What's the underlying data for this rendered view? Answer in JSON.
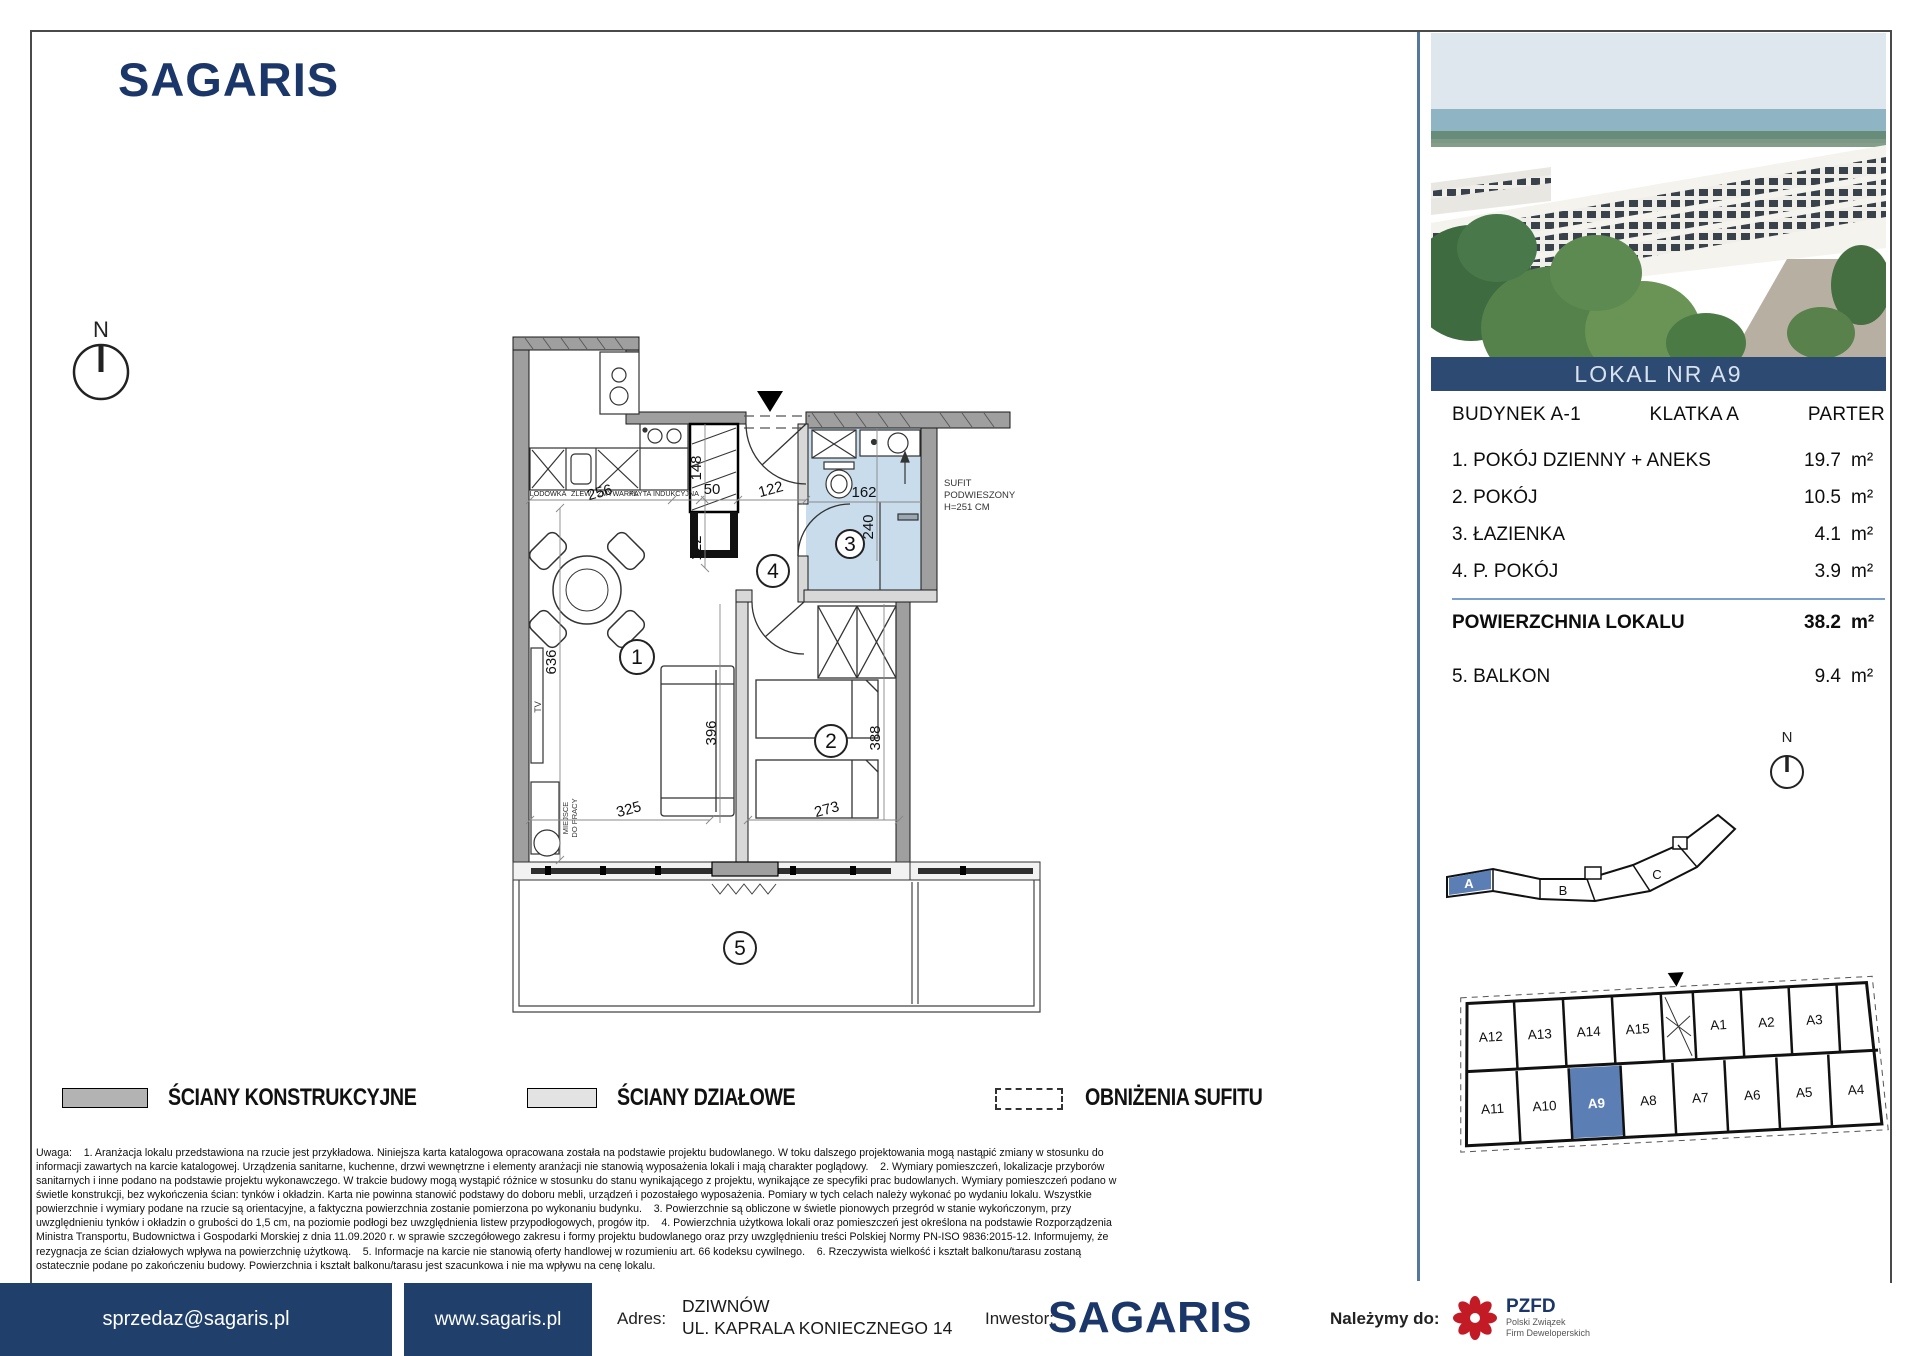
{
  "brand": {
    "logo": "SAGARIS"
  },
  "photo_banner": {
    "label": "LOKAL NR A9"
  },
  "unit_table": {
    "building": "BUDYNEK A-1",
    "staircase": "KLATKA A",
    "floor": "PARTER",
    "rooms": [
      {
        "name": "1. POKÓJ DZIENNY + ANEKS",
        "area": "19.7",
        "unit": "m²"
      },
      {
        "name": "2. POKÓJ",
        "area": "10.5",
        "unit": "m²"
      },
      {
        "name": "3. ŁAZIENKA",
        "area": "4.1",
        "unit": "m²"
      },
      {
        "name": "4. P. POKÓJ",
        "area": "3.9",
        "unit": "m²"
      }
    ],
    "total_label": "POWIERZCHNIA LOKALU",
    "total_area": "38.2",
    "total_unit": "m²",
    "balcony_label": "5. BALKON",
    "balcony_area": "9.4",
    "balcony_unit": "m²"
  },
  "floor_plan": {
    "north": "N",
    "rooms": {
      "r1": "1",
      "r2": "2",
      "r3": "3",
      "r4": "4",
      "r5": "5"
    },
    "dims": {
      "kitchen": "256",
      "shaft_w": "50",
      "hall_w": "122",
      "shaft_h": "148",
      "hall_h": "122",
      "living_h": "636",
      "living_w": "325",
      "sofa_l": "396",
      "bed_w": "273",
      "bed_h": "388",
      "bath_w": "162",
      "bath_h": "240"
    },
    "kitchen_labels": {
      "fridge": "LODÓWKA",
      "sink": "ZLEW",
      "dishwasher": "ZMYWARKA",
      "hob": "PŁYTA INDUKCYJNA"
    },
    "tv_label": "TV",
    "workspace_l1": "MIEJSCE",
    "workspace_l2": "DO PRACY",
    "ceiling_note_l1": "SUFIT",
    "ceiling_note_l2": "PODWIESZONY",
    "ceiling_note_l3": "H=251 CM"
  },
  "legend": {
    "item1": "ŚCIANY KONSTRUKCYJNE",
    "item2": "ŚCIANY DZIAŁOWE",
    "item3": "OBNIŻENIA SUFITU"
  },
  "site_plan": {
    "a": "A",
    "b": "B",
    "c": "C"
  },
  "unit_map": {
    "top_row": [
      "A12",
      "A13",
      "A14",
      "A15",
      "A1",
      "A2",
      "A3"
    ],
    "bottom_row": [
      "A11",
      "A10",
      "A9",
      "A8",
      "A7",
      "A6",
      "A5",
      "A4"
    ],
    "highlighted": "A9"
  },
  "disclaimer": "Uwaga:    1. Aranżacja lokalu przedstawiona na rzucie jest przykładowa. Niniejsza karta katalogowa opracowana została na podstawie projektu budowlanego. W toku dalszego projektowania mogą nastąpić zmiany w stosunku do informacji zawartych na karcie katalogowej. Urządzenia sanitarne, kuchenne, drzwi wewnętrzne i elementy aranżacji nie stanowią wyposażenia lokali i mają charakter poglądowy.    2. Wymiary pomieszczeń, lokalizacje przyborów sanitarnych i inne podano na podstawie projektu wykonawczego. W trakcie budowy mogą wystąpić różnice w stosunku do stanu wynikającego z projektu, wynikające ze specyfiki prac budowlanych. Wymiary pomieszczeń podano w świetle konstrukcji, bez wykończenia ścian: tynków i okładzin. Karta nie powinna stanowić podstawy do doboru mebli, urządzeń i pozostałego wyposażenia. Pomiary w tych celach należy wykonać po wydaniu lokalu. Wszystkie powierzchnie i wymiary podane na rzucie są orientacyjne, a faktyczna powierzchnia zostanie pomierzona po wykonaniu budynku.    3. Powierzchnie są obliczone w świetle pionowych przegród w stanie wykończonym, przy uwzględnieniu tynków i okładzin o grubości do 1,5 cm, na poziomie podłogi bez uwzględnienia listew przypodłogowych, progów itp.    4. Powierzchnia użytkowa lokali oraz pomieszczeń jest określona na podstawie Rozporządzenia Ministra Transportu, Budownictwa i Gospodarki Morskiej z dnia 11.09.2020 r. w sprawie szczegółowego zakresu i formy projektu budowlanego oraz przy uwzględnieniu treści Polskiej Normy PN-ISO 9836:2015-12. Informujemy, że rezygnacja ze ścian działowych wpływa na powierzchnię użytkową.    5. Informacje na karcie nie stanowią oferty handlowej w rozumieniu art. 66 kodeksu cywilnego.    6. Rzeczywista wielkość i kształt balkonu/tarasu zostaną ostatecznie podane po zakończeniu budowy. Powierzchnia i kształt balkonu/tarasu jest szacunkowa i nie ma wpływu na cenę lokalu.",
  "footer": {
    "email": "sprzedaz@sagaris.pl",
    "website": "www.sagaris.pl",
    "address_label": "Adres:",
    "address_line1": "DZIWNÓW",
    "address_line2": "UL. KAPRALA KONIECZNEGO 14",
    "investor_label": "Inwestor:",
    "investor_logo": "SAGARIS",
    "member_label": "Należymy do:",
    "pzfd_abbr": "PZFD",
    "pzfd_line1": "Polski Związek",
    "pzfd_line2": "Firm Deweloperskich"
  }
}
